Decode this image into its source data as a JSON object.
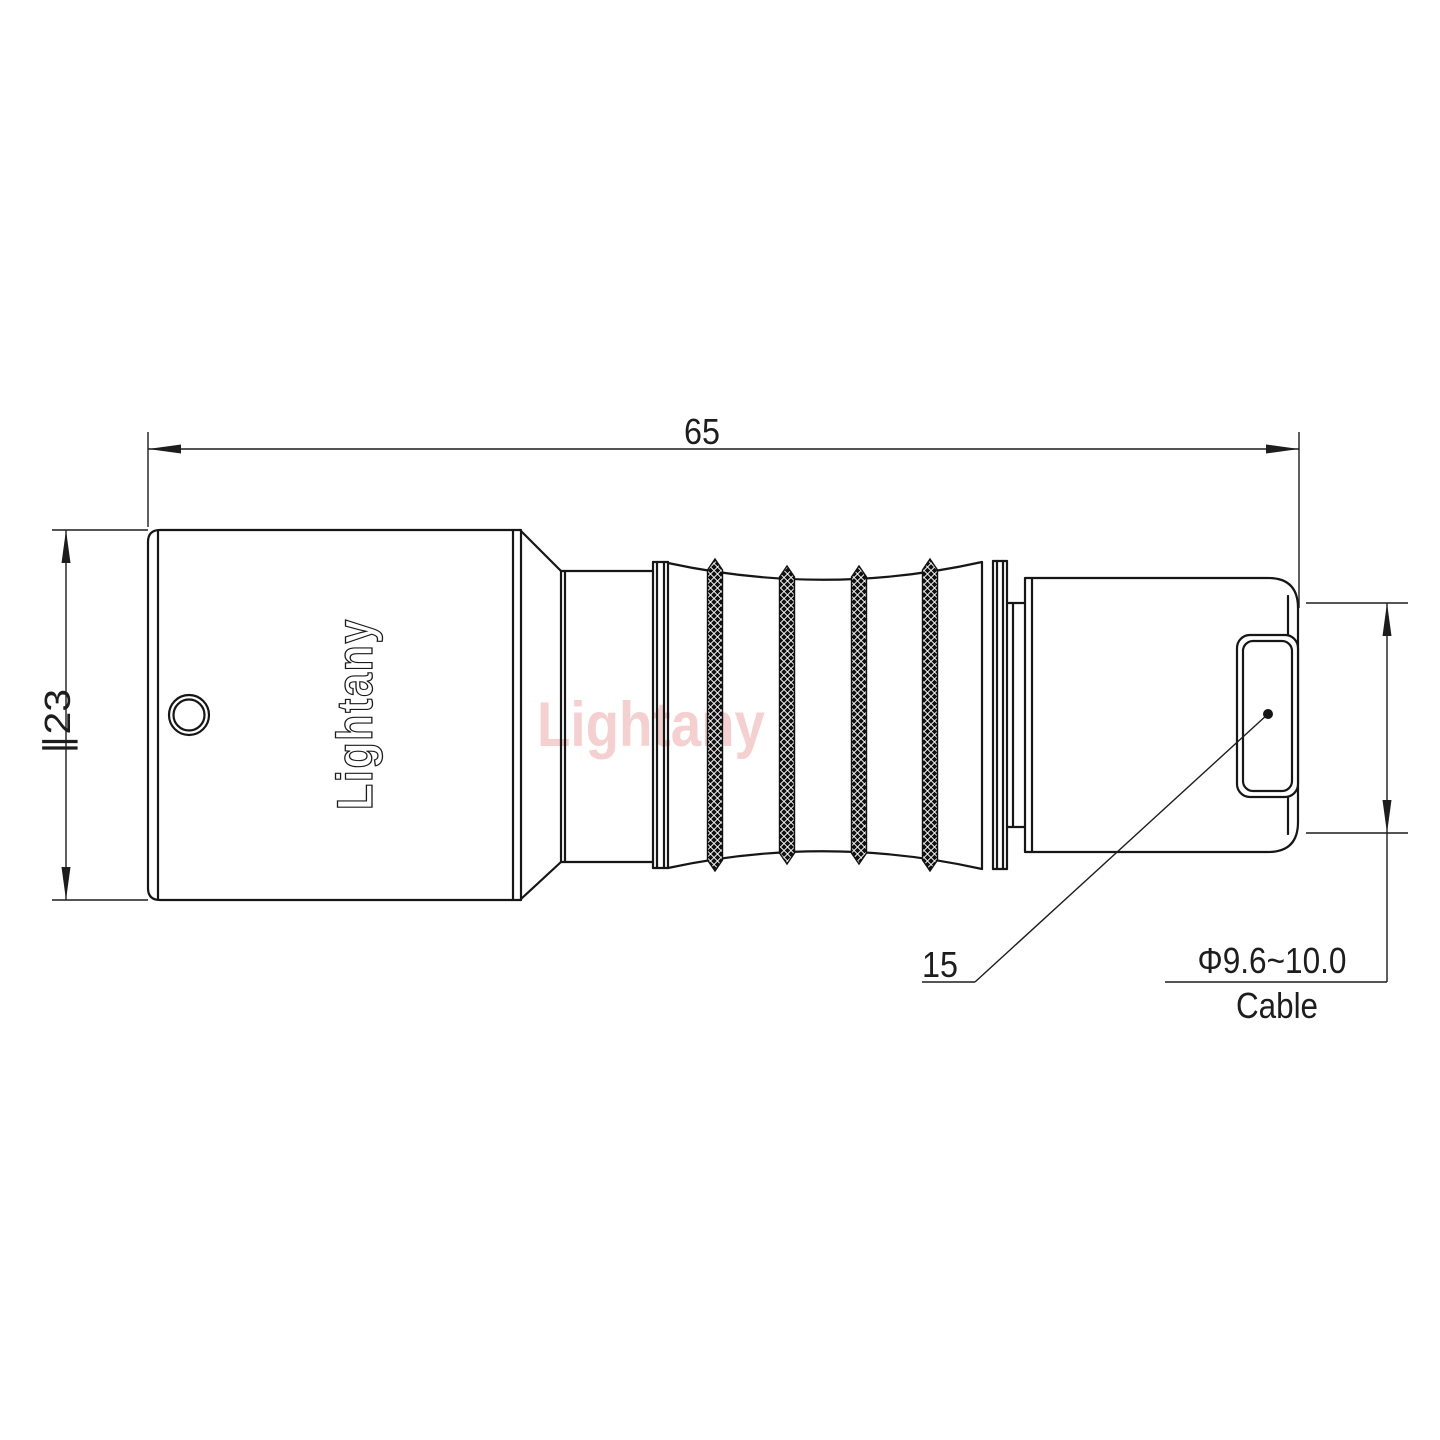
{
  "drawing": {
    "type": "connector-technical-drawing",
    "dimensions": {
      "overall_length": "65",
      "body_diameter": "∥23",
      "part_callout": "15",
      "cable_diameter_range": "Φ9.6~10.0",
      "cable_label": "Cable"
    },
    "branding": {
      "engraved_logo": "Lightany",
      "watermark": "Lightany"
    },
    "colors": {
      "line": "#161616",
      "dimension_line": "#1d1d1d",
      "watermark_pink": "#f5d0d0",
      "background": "#ffffff",
      "knurl_dark": "#111111"
    }
  }
}
